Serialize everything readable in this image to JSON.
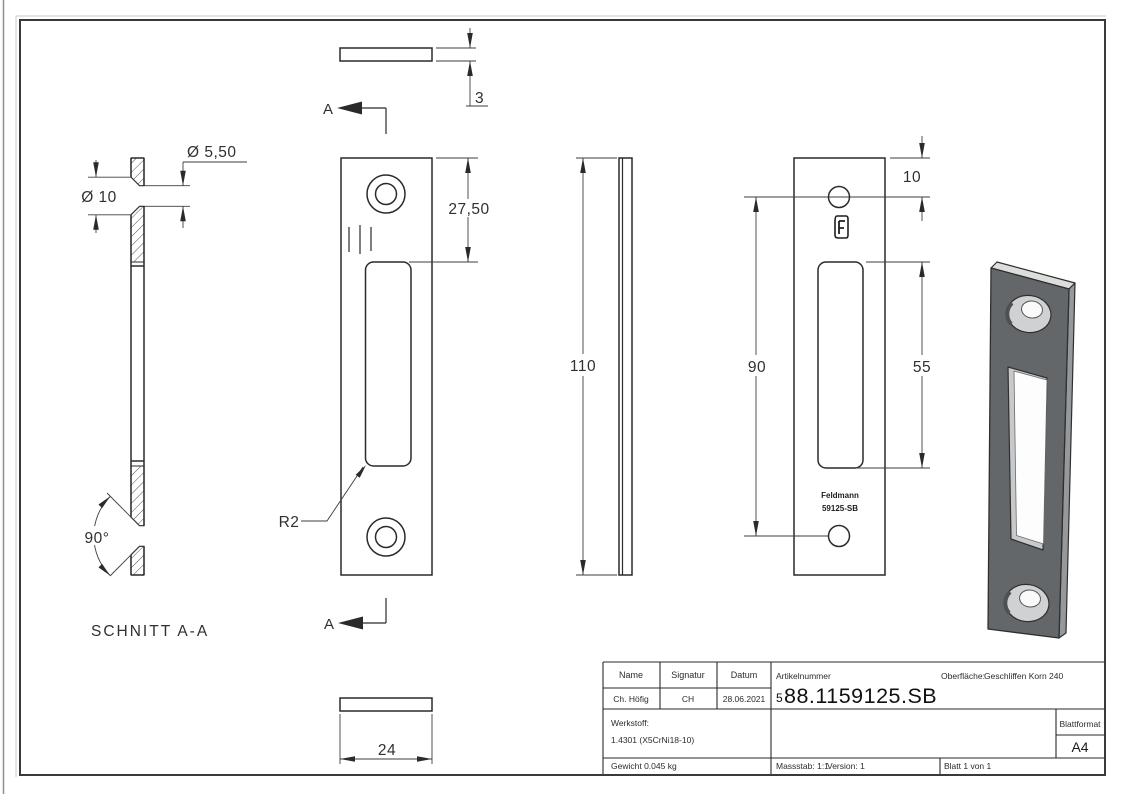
{
  "drawing": {
    "section_label": "SCHNITT A-A",
    "section_mark": "A",
    "dims": {
      "countersink_dia": "Ø 5,50",
      "hole_dia": "Ø 10",
      "countersink_angle": "90°",
      "thickness": "3",
      "hole_offset_top": "27,50",
      "slot_corner_radius": "R2",
      "height": "110",
      "width": "24",
      "back_hole_top": "10",
      "back_hole_spacing": "90",
      "back_slot_height": "55"
    },
    "engraving": {
      "brand": "Feldmann",
      "code": "59125-SB"
    }
  },
  "title_block": {
    "headers": {
      "name": "Name",
      "signature": "Signatur",
      "date": "Datum"
    },
    "values": {
      "name": "Ch. Höfig",
      "signature": "CH",
      "date": "28.06.2021"
    },
    "article": {
      "label": "Artikelnummer",
      "prefix": "5",
      "number": "88.1159125.SB"
    },
    "surface": {
      "label": "Oberfläche:",
      "value": "Geschliffen Korn 240"
    },
    "material": {
      "label": "Werkstoff:",
      "value": "1.4301 (X5CrNi18-10)"
    },
    "weight": "Gewicht 0.045 kg",
    "scale": "Massstab: 1:1",
    "version": "Version: 1",
    "sheet": "Blatt 1 von 1",
    "format": {
      "label": "Blattformat",
      "value": "A4"
    }
  },
  "colors": {
    "outline": "#2a2a2a",
    "iso_front": "#64676a",
    "iso_top": "#dcdddd",
    "iso_side": "#96999b",
    "iso_slot_wall": "#c7c9ca"
  }
}
